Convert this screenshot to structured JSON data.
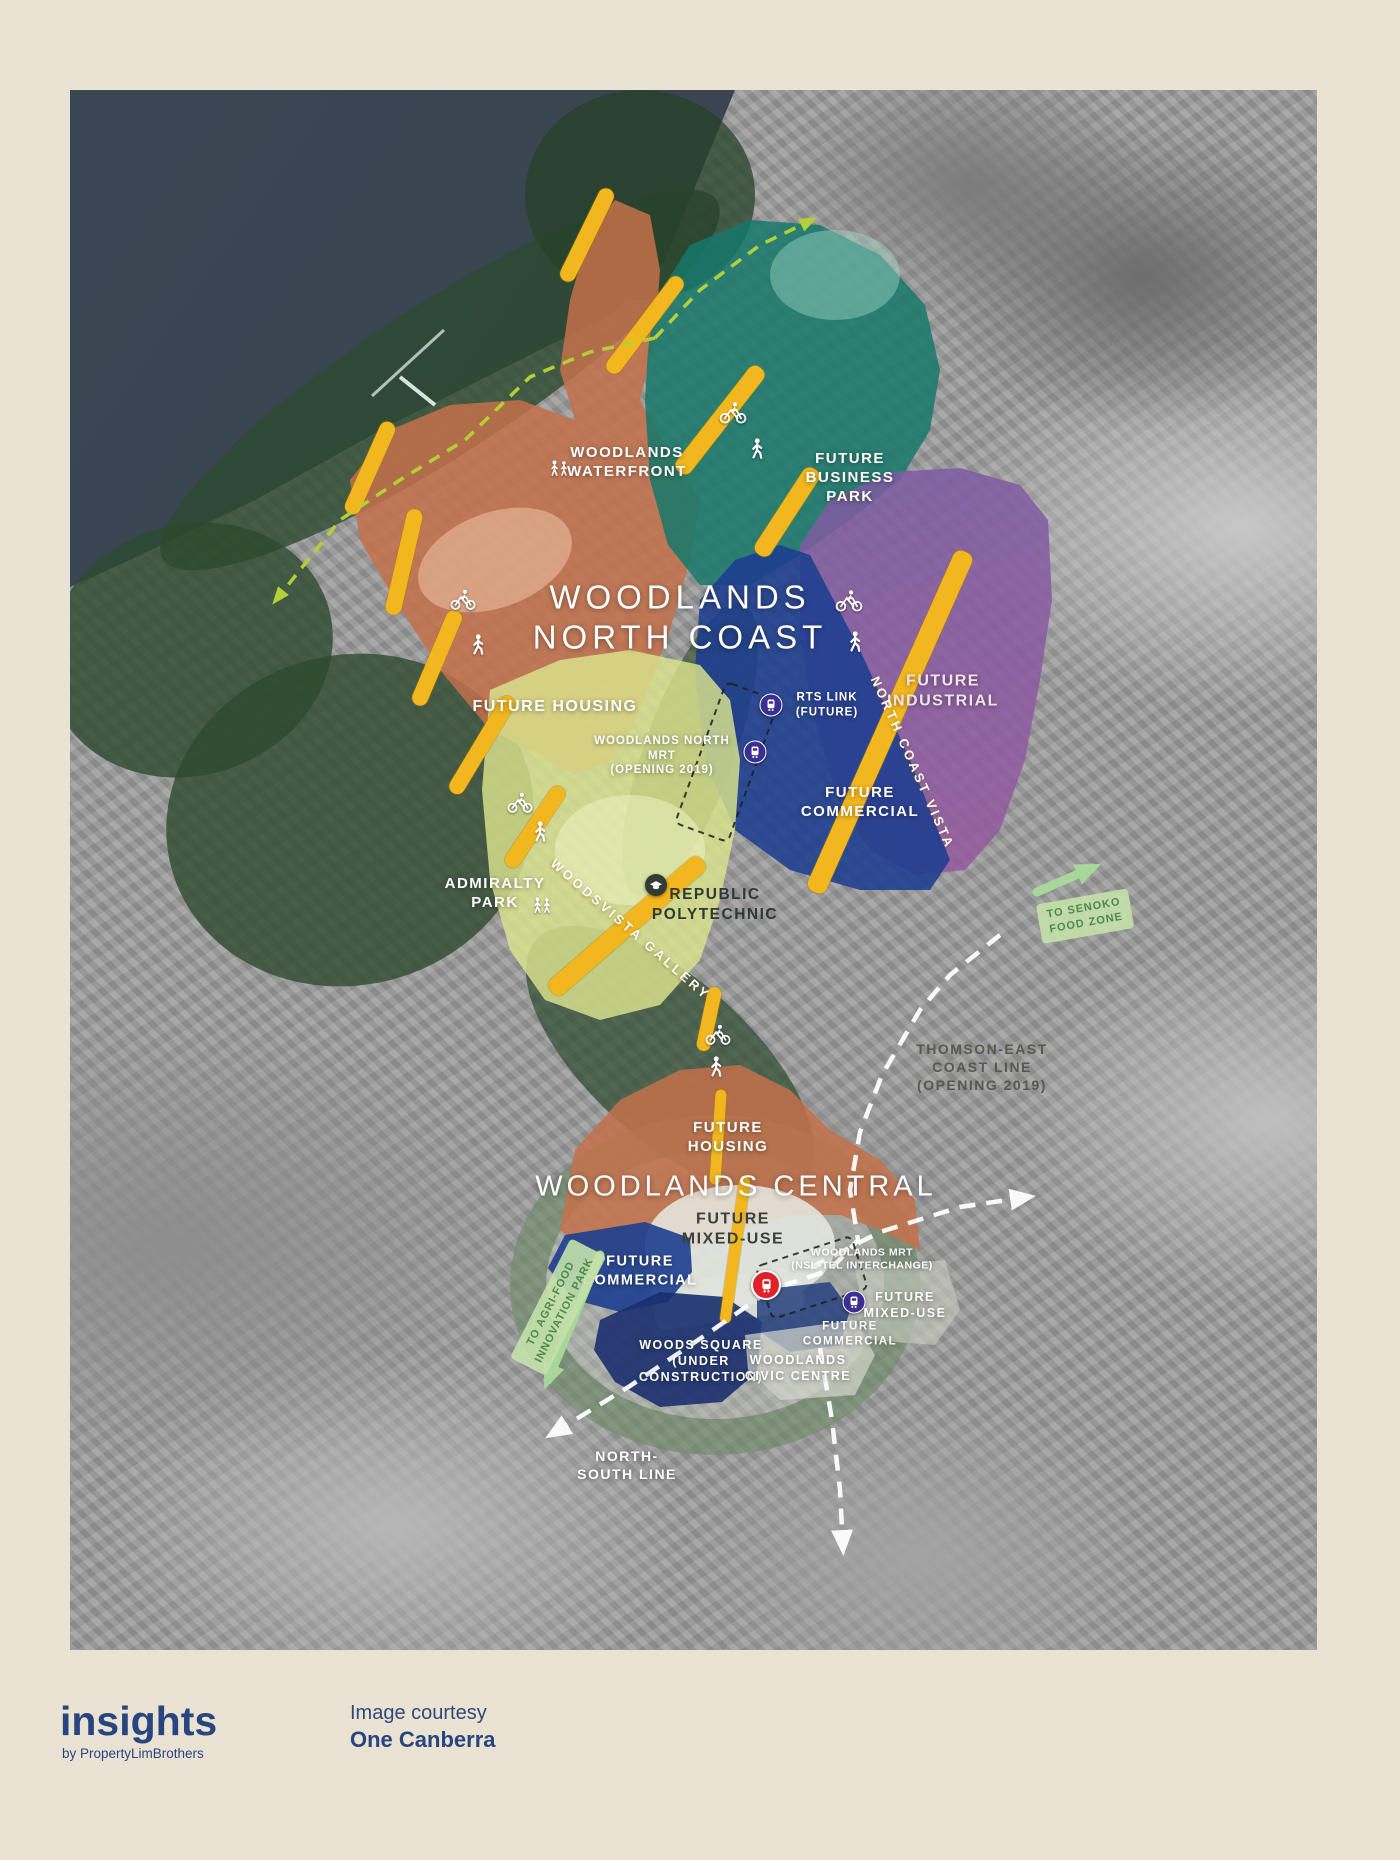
{
  "footer": {
    "brand": "insights",
    "brand_sub": "by PropertyLimBrothers",
    "credit_line1": "Image courtesy",
    "credit_line2": "One Canberra"
  },
  "map": {
    "labels": {
      "woodlands_waterfront": "WOODLANDS\nWATERFRONT",
      "future_business_park": "FUTURE\nBUSINESS\nPARK",
      "woodlands_north_coast": "WOODLANDS\nNORTH COAST",
      "future_housing_north": "FUTURE HOUSING",
      "woodlands_north_mrt": "WOODLANDS NORTH\nMRT\n(OPENING 2019)",
      "rts_link": "RTS LINK\n(FUTURE)",
      "future_commercial_north": "FUTURE\nCOMMERCIAL",
      "future_industrial": "FUTURE\nINDUSTRIAL",
      "north_coast_vista": "NORTH COAST VISTA",
      "admiralty_park": "ADMIRALTY\nPARK",
      "woodsvista_gallery": "WOODSVISTA GALLERY",
      "republic_polytechnic": "REPUBLIC\nPOLYTECHNIC",
      "to_senoko_food_zone": "TO SENOKO\nFOOD ZONE",
      "thomson_east_coast_line": "THOMSON-EAST\nCOAST LINE\n(OPENING 2019)",
      "future_housing_central": "FUTURE\nHOUSING",
      "woodlands_central": "WOODLANDS CENTRAL",
      "future_mixed_use_central": "FUTURE\nMIXED-USE",
      "future_commercial_central_left": "FUTURE\nCOMMERCIAL",
      "woodlands_mrt": "WOODLANDS MRT\n(NSL-TEL INTERCHANGE)",
      "future_mixed_use_east": "FUTURE\nMIXED-USE",
      "future_commercial_central_right": "FUTURE\nCOMMERCIAL",
      "woods_square": "WOODS SQUARE\n(UNDER\nCONSTRUCTION)",
      "woodlands_civic_centre": "WOODLANDS\nCIVIC CENTRE",
      "to_agri_food_innovation_park": "TO AGRI-FOOD\nINNOVATION PARK",
      "north_south_line": "NORTH-\nSOUTH LINE"
    },
    "colors": {
      "page_background": "#eae2d3",
      "brand_navy": "#27457f",
      "water": "#39434f",
      "park_green": "#2c4a2e",
      "housing_orange": "#c4714a",
      "business_park_teal": "#15786a",
      "commercial_blue": "#1c3e8f",
      "industrial_purple": "#7b5ba3",
      "industrial_magenta": "#a7589d",
      "polytechnic_green": "#dce48e",
      "road_yellow": "#f2b71e",
      "mrt_purple": "#3b2f91",
      "mrt_red": "#e02128",
      "boundary_dash_green": "#b5cf36",
      "direction_arrow_green": "#a8d79a",
      "rail_dash_white": "#ffffff"
    },
    "icons": {
      "mrt_station_icon": "train-in-circle",
      "cyclist_icon": "bicycle",
      "pedestrian_icon": "walking-person",
      "park_visitors_icon": "people-walking",
      "polytechnic_icon": "graduation-cap"
    }
  }
}
